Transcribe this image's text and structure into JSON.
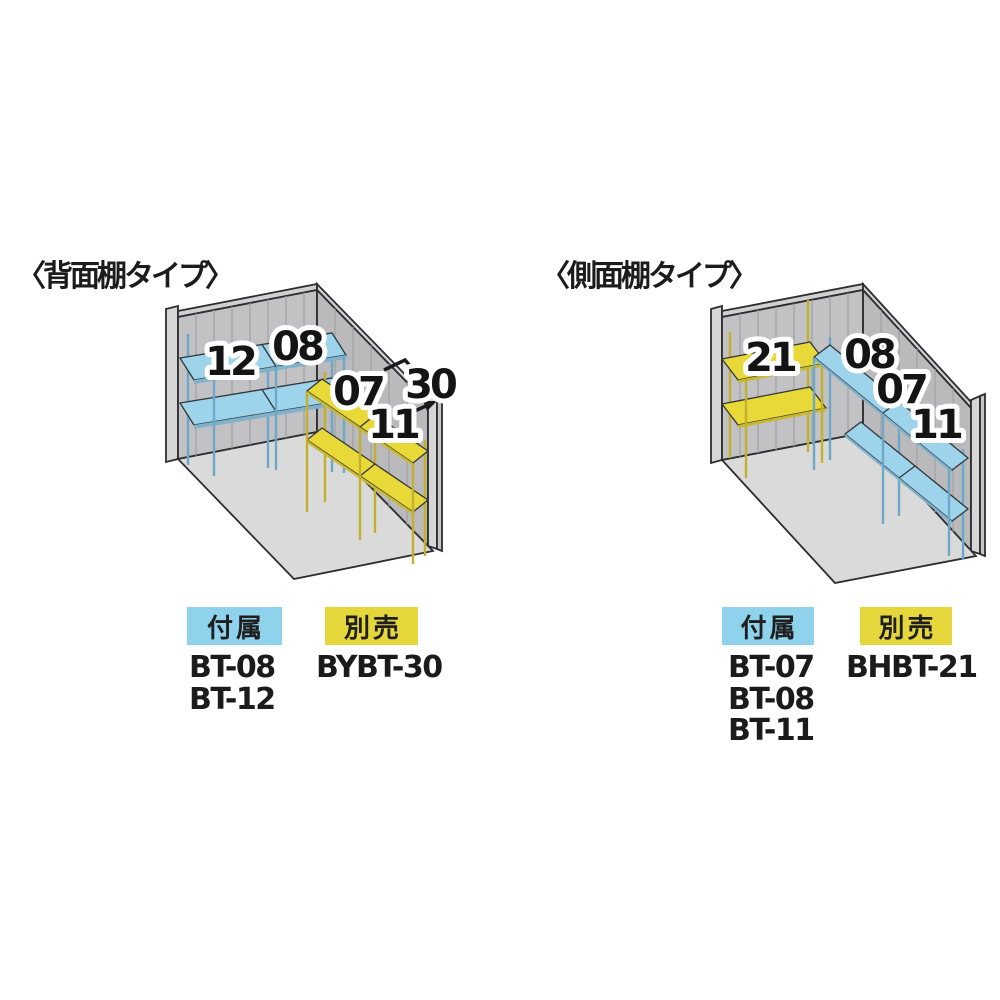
{
  "colors": {
    "shelf_blue": "#9dd4ec",
    "shelf_blue_edge": "#7fb2cc",
    "shelf_yellow": "#e8d838",
    "shelf_yellow_edge": "#c9b931",
    "post_blue": "#6ea8c8",
    "post_yellow": "#c3b02c",
    "badge_included_bg": "#8ed2ec",
    "badge_optional_bg": "#e5d63c",
    "wall_back": "#c2c2c4",
    "wall_side": "#bababc",
    "wall_top_strip": "#d0d0d1",
    "end_cap": "#d6d6d7",
    "floor": "#dadada"
  },
  "left_diagram": {
    "title": "〈背面棚タイプ〉",
    "shelf_labels": {
      "back_upper_left": "12",
      "back_upper_right": "08",
      "side_upper": "07",
      "side_lower": "11",
      "side_extension": "30"
    },
    "legend": {
      "included_label": "付属",
      "included_items": [
        "BT-08",
        "BT-12"
      ],
      "optional_label": "別売",
      "optional_items": [
        "BYBT-30"
      ]
    }
  },
  "right_diagram": {
    "title": "〈側面棚タイプ〉",
    "shelf_labels": {
      "back_shelf": "21",
      "side_top": "08",
      "side_middle": "07",
      "side_bottom": "11"
    },
    "legend": {
      "included_label": "付属",
      "included_items": [
        "BT-07",
        "BT-08",
        "BT-11"
      ],
      "optional_label": "別売",
      "optional_items": [
        "BHBT-21"
      ]
    }
  }
}
